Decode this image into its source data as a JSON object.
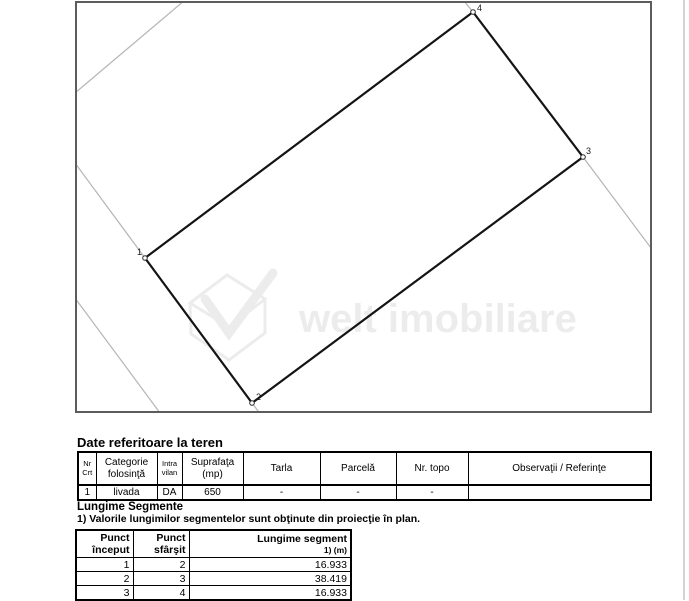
{
  "map": {
    "border_color": "#5c5c5c",
    "parcel_stroke": "#141414",
    "neighbor_stroke": "#b5b5b5",
    "vertices": [
      {
        "label": "1",
        "x": 68,
        "y": 255,
        "lx": 60,
        "ly": 252
      },
      {
        "label": "2",
        "x": 175,
        "y": 400,
        "lx": 179,
        "ly": 397
      },
      {
        "label": "3",
        "x": 506,
        "y": 154,
        "lx": 509,
        "ly": 151
      },
      {
        "label": "4",
        "x": 396,
        "y": 9,
        "lx": 400,
        "ly": 8
      }
    ],
    "neighbor_lines": [
      {
        "x1": -2,
        "y1": 90,
        "x2": 108,
        "y2": -3
      },
      {
        "x1": -2,
        "y1": 295,
        "x2": 86,
        "y2": 414
      },
      {
        "x1": -2,
        "y1": 160,
        "x2": 68,
        "y2": 255
      },
      {
        "x1": 175,
        "y1": 400,
        "x2": 184,
        "y2": 412
      },
      {
        "x1": 506,
        "y1": 154,
        "x2": 574,
        "y2": 245
      },
      {
        "x1": 387,
        "y1": -2,
        "x2": 396,
        "y2": 9
      }
    ],
    "watermark": {
      "text": "welt imobiliare"
    }
  },
  "land_section": {
    "title": "Date referitoare la teren",
    "table": {
      "headers": {
        "nr": {
          "l1": "Nr",
          "l2": "Crt"
        },
        "categorie": {
          "l1": "Categorie",
          "l2": "folosinţă"
        },
        "intravilan": {
          "l1": "Intra",
          "l2": "vilan"
        },
        "suprafata": {
          "l1": "Suprafaţa",
          "l2": "(mp)"
        },
        "tarla": {
          "l1": "Tarla"
        },
        "parcela": {
          "l1": "Parcelă"
        },
        "nrtopo": {
          "l1": "Nr. topo"
        },
        "observatii": {
          "l1": "Observaţii / Referinţe"
        }
      },
      "rows": [
        [
          "1",
          "livada",
          "DA",
          "650",
          "-",
          "-",
          "-",
          ""
        ]
      ]
    }
  },
  "segments_section": {
    "title": "Lungime Segmente",
    "note": "1) Valorile lungimilor segmentelor sunt obţinute din proiecţie în plan.",
    "table": {
      "headers": {
        "start": {
          "l1": "Punct",
          "l2": "început"
        },
        "end": {
          "l1": "Punct",
          "l2": "sfârşit"
        },
        "length": {
          "l1": "Lungime segment",
          "unit": "1) (m)"
        }
      },
      "rows": [
        [
          "1",
          "2",
          "16.933"
        ],
        [
          "2",
          "3",
          "38.419"
        ],
        [
          "3",
          "4",
          "16.933"
        ]
      ]
    }
  }
}
